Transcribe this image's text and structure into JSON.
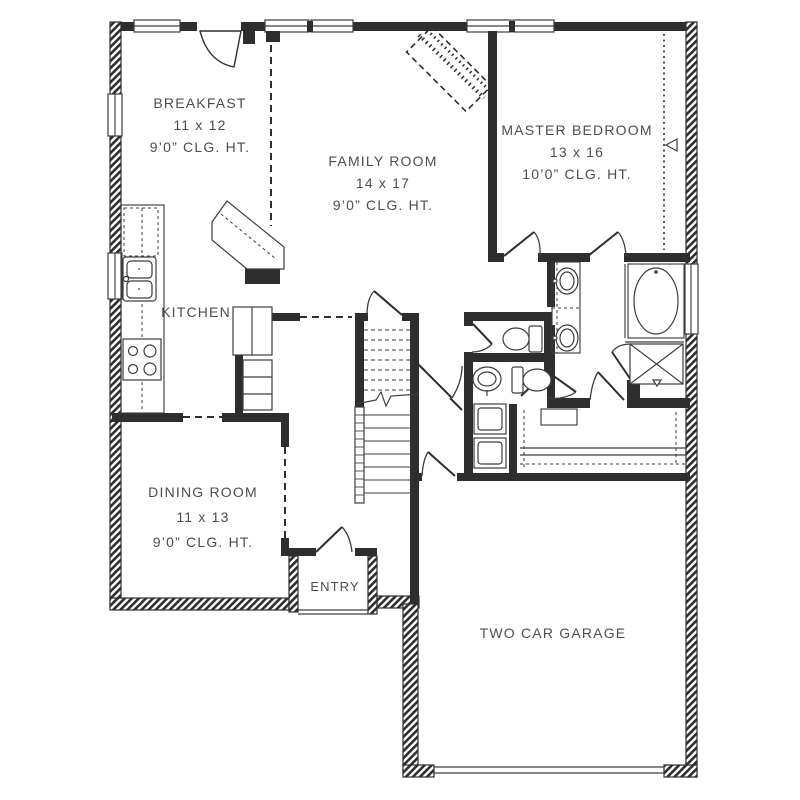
{
  "plan": {
    "title": "First Floor Plan",
    "rooms": [
      {
        "id": "breakfast",
        "name": "BREAKFAST",
        "dims": "11 x 12",
        "ceiling": "9’0” CLG. HT."
      },
      {
        "id": "family_room",
        "name": "FAMILY ROOM",
        "dims": "14 x 17",
        "ceiling": "9’0” CLG. HT."
      },
      {
        "id": "master_bedroom",
        "name": "MASTER BEDROOM",
        "dims": "13 x 16",
        "ceiling": "10’0” CLG. HT."
      },
      {
        "id": "kitchen",
        "name": "KITCHEN"
      },
      {
        "id": "dining_room",
        "name": "DINING ROOM",
        "dims": "11 x 13",
        "ceiling": "9’0” CLG. HT."
      },
      {
        "id": "entry",
        "name": "ENTRY"
      },
      {
        "id": "garage",
        "name": "TWO CAR GARAGE"
      }
    ],
    "fixtures": [
      "kitchen-sink",
      "cooktop",
      "refrigerator",
      "pantry",
      "stairs",
      "tub",
      "shower",
      "double-vanity",
      "toilet",
      "toilet",
      "pedestal-sink",
      "washer",
      "dryer",
      "corner-fireplace"
    ],
    "colors": {
      "wall": "#2e2e2e",
      "line": "#3d3d3d",
      "text": "#4e4e4e",
      "background": "#ffffff"
    }
  }
}
